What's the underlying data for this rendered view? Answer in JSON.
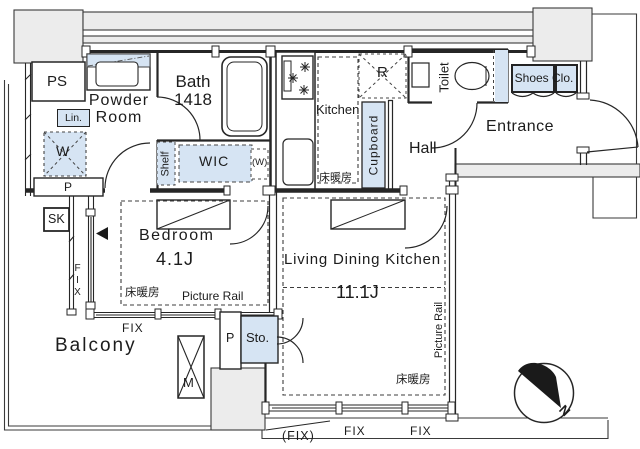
{
  "colors": {
    "accent_blue": "#d6e4f3",
    "wall_gray": "#ececec",
    "line": "#262626"
  },
  "labels": {
    "ps": "PS",
    "powder_line1": "Powder",
    "powder_line2": "Room",
    "lin": "Lin.",
    "washer": "W",
    "pipe_left": "P",
    "sk": "SK",
    "bath_line1": "Bath",
    "bath_line2": "1418",
    "shelf": "Shelf",
    "wic": "WIC",
    "w_paren": "(W)",
    "kitchen": "Kitchen",
    "kitchen_floor_heating": "床暖房",
    "fridge": "R",
    "cupboard": "Cupboard",
    "toilet": "Toilet",
    "shoes_closet": "Shoes Clo.",
    "entrance": "Entrance",
    "hall": "Hall",
    "bedroom": "Bedroom",
    "bedroom_size": "4.1J",
    "bedroom_floor_heating": "床暖房",
    "picture_rail": "Picture Rail",
    "ldk": "Living Dining Kitchen",
    "ldk_size": "11.1J",
    "ldk_floor_heating": "床暖房",
    "picture_rail_vertical": "Picture Rail",
    "balcony": "Balcony",
    "meter": "M",
    "pipe_bottom": "P",
    "storage": "Sto.",
    "fix": "FIX",
    "fix_paren": "(FIX)",
    "north": "N"
  }
}
